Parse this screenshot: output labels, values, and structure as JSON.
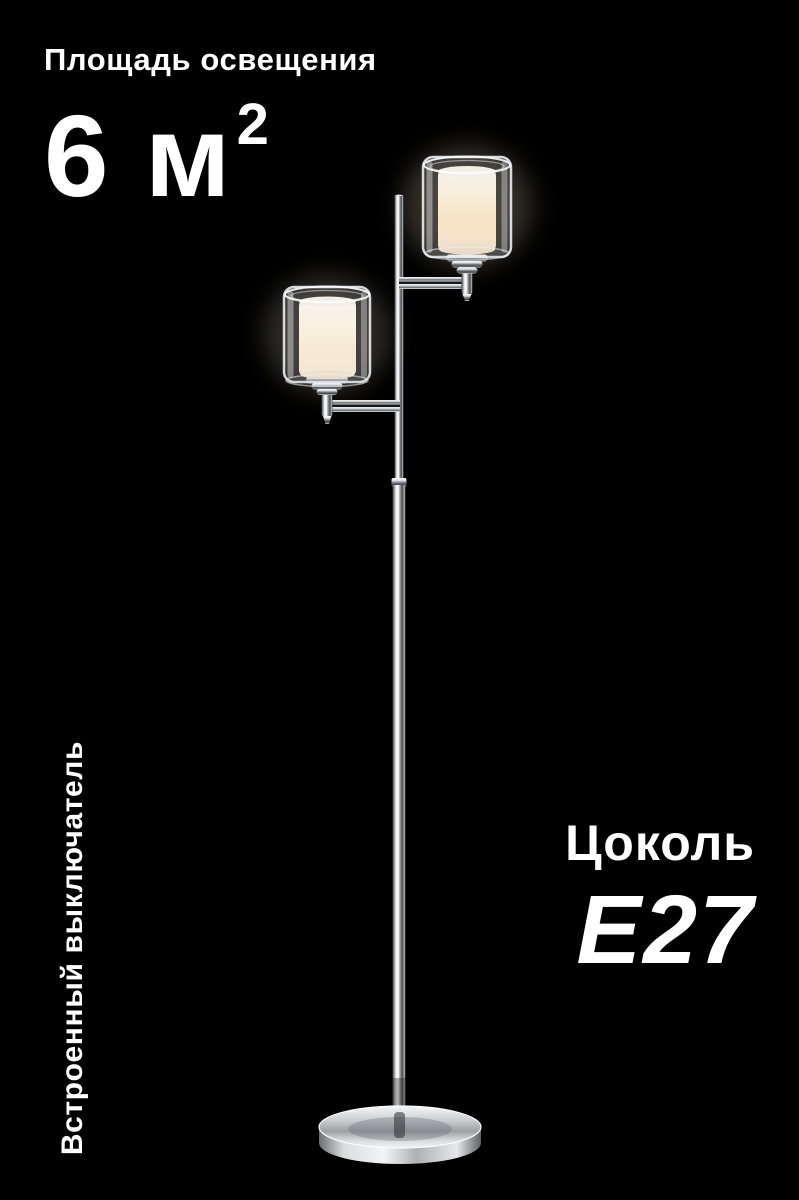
{
  "background_color": "#000000",
  "text_color": "#ffffff",
  "lighting_area": {
    "label": "Площадь освещения",
    "value": "6 м",
    "value_sup": "2"
  },
  "socket": {
    "label": "Цоколь",
    "value": "E27"
  },
  "switch_note": {
    "label": "Встроенный выключатель"
  },
  "product_image": {
    "name": "two-light-chrome-floor-lamp",
    "shade_glow_color": "#fbe3c3",
    "chrome_highlight_color": "#ffffff",
    "chrome_shadow_color": "#2e2e30"
  }
}
